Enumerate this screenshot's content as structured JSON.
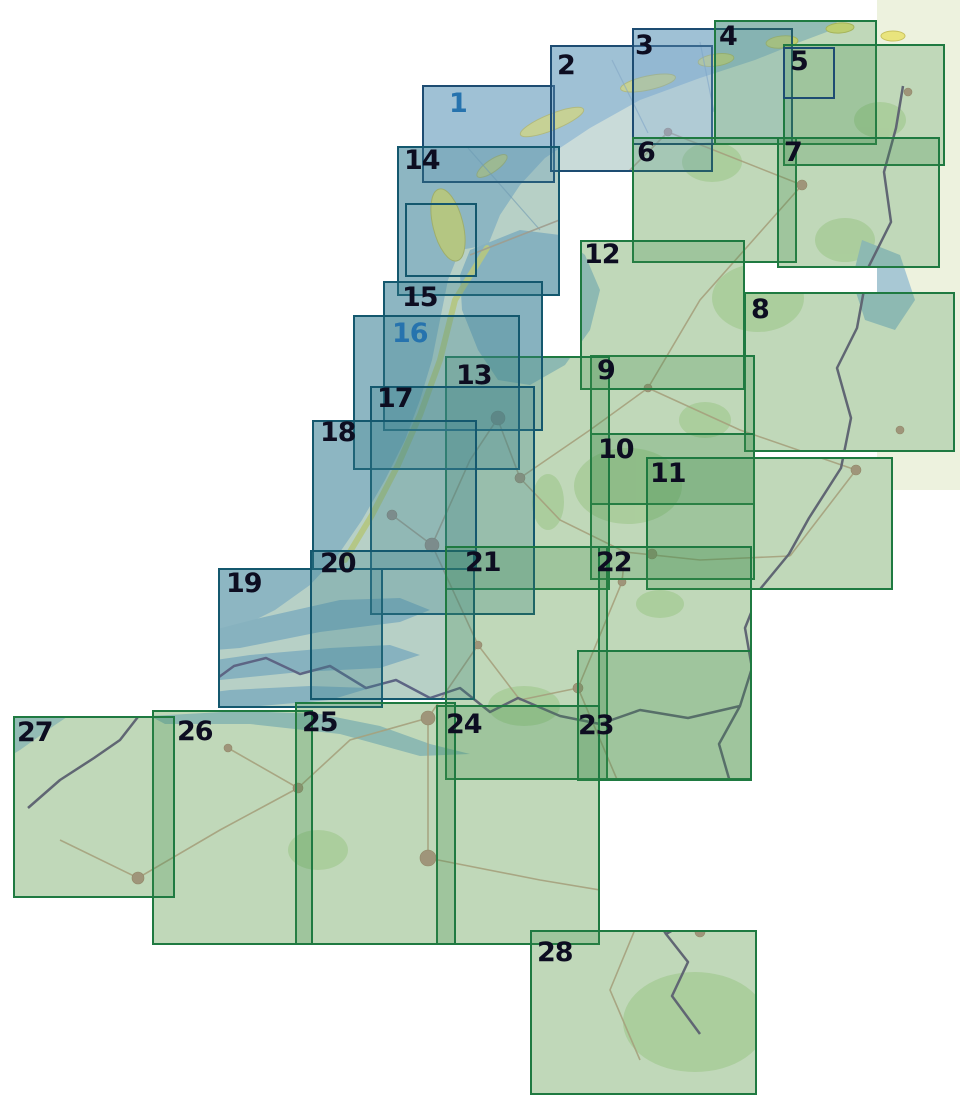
{
  "map_index": {
    "description": "Sheet index map of a 28-part map series covering the Netherlands and Flanders; numbered translucent rectangles overlap a topographic base map",
    "palette": {
      "background": "#ffffff",
      "sea": "#b0cdd9",
      "land": "#edf2de",
      "forest": "#cfe3b6",
      "dune_yellow": "#e9e47d",
      "road": "#c9a88e",
      "city": "#c1998a",
      "country_border": "#6c5a80",
      "admin_sea_line": "#88a6c2",
      "wadden_series_border": "#1d4c72",
      "coast_series_border": "#14586e",
      "inland_series_border": "#1f7a41",
      "wadden_series_fill": "rgba(118,166,204,0.30)",
      "coast_series_fill": "rgba(58,128,142,0.30)",
      "inland_series_fill": "rgba(58,138,74,0.25)",
      "number_color": "#0d0d21",
      "number_highlight_color": "#2673ae"
    },
    "sheets": [
      {
        "number": "1",
        "series": "wadden",
        "x": 422,
        "y": 85,
        "w": 133,
        "h": 98,
        "label_x": 449,
        "label_y": 90,
        "label_color": "blue"
      },
      {
        "number": "2",
        "series": "wadden",
        "x": 550,
        "y": 45,
        "w": 163,
        "h": 127,
        "label_x": 557,
        "label_y": 52,
        "label_color": "dark"
      },
      {
        "number": "3",
        "series": "wadden",
        "x": 632,
        "y": 28,
        "w": 161,
        "h": 117,
        "label_x": 635,
        "label_y": 32,
        "label_color": "dark"
      },
      {
        "number": "4",
        "series": "inland",
        "x": 714,
        "y": 20,
        "w": 163,
        "h": 125,
        "label_x": 719,
        "label_y": 23,
        "label_color": "dark"
      },
      {
        "number": "5",
        "series": "inland",
        "x": 783,
        "y": 44,
        "w": 162,
        "h": 122,
        "label_x": 790,
        "label_y": 48,
        "label_color": "dark"
      },
      {
        "number": "6",
        "series": "inland",
        "x": 632,
        "y": 137,
        "w": 165,
        "h": 126,
        "label_x": 637,
        "label_y": 139,
        "label_color": "dark"
      },
      {
        "number": "7",
        "series": "inland",
        "x": 777,
        "y": 137,
        "w": 163,
        "h": 131,
        "label_x": 784,
        "label_y": 139,
        "label_color": "dark"
      },
      {
        "number": "8",
        "series": "inland",
        "x": 744,
        "y": 292,
        "w": 211,
        "h": 160,
        "label_x": 751,
        "label_y": 296,
        "label_color": "dark"
      },
      {
        "number": "9",
        "series": "inland",
        "x": 590,
        "y": 355,
        "w": 165,
        "h": 150,
        "label_x": 597,
        "label_y": 357,
        "label_color": "dark"
      },
      {
        "number": "10",
        "series": "inland",
        "x": 590,
        "y": 433,
        "w": 165,
        "h": 147,
        "label_x": 598,
        "label_y": 436,
        "label_color": "dark"
      },
      {
        "number": "11",
        "series": "inland",
        "x": 646,
        "y": 457,
        "w": 247,
        "h": 133,
        "label_x": 650,
        "label_y": 460,
        "label_color": "dark"
      },
      {
        "number": "12",
        "series": "inland",
        "x": 580,
        "y": 240,
        "w": 165,
        "h": 150,
        "label_x": 584,
        "label_y": 241,
        "label_color": "dark"
      },
      {
        "number": "13",
        "series": "inland",
        "x": 445,
        "y": 356,
        "w": 165,
        "h": 234,
        "label_x": 456,
        "label_y": 362,
        "label_color": "dark"
      },
      {
        "number": "14",
        "series": "coast",
        "x": 397,
        "y": 146,
        "w": 163,
        "h": 150,
        "label_x": 404,
        "label_y": 147,
        "label_color": "dark"
      },
      {
        "number": "15",
        "series": "coast",
        "x": 383,
        "y": 281,
        "w": 160,
        "h": 150,
        "label_x": 402,
        "label_y": 284,
        "label_color": "dark"
      },
      {
        "number": "16",
        "series": "coast",
        "x": 353,
        "y": 315,
        "w": 167,
        "h": 155,
        "label_x": 392,
        "label_y": 320,
        "label_color": "blue"
      },
      {
        "number": "17",
        "series": "coast",
        "x": 370,
        "y": 386,
        "w": 165,
        "h": 229,
        "label_x": 377,
        "label_y": 385,
        "label_color": "dark"
      },
      {
        "number": "18",
        "series": "coast",
        "x": 312,
        "y": 420,
        "w": 165,
        "h": 150,
        "label_x": 320,
        "label_y": 419,
        "label_color": "dark"
      },
      {
        "number": "19",
        "series": "coast",
        "x": 218,
        "y": 568,
        "w": 165,
        "h": 140,
        "label_x": 226,
        "label_y": 570,
        "label_color": "dark"
      },
      {
        "number": "20",
        "series": "coast",
        "x": 310,
        "y": 550,
        "w": 165,
        "h": 150,
        "label_x": 320,
        "label_y": 550,
        "label_color": "dark"
      },
      {
        "number": "21",
        "series": "inland",
        "x": 445,
        "y": 546,
        "w": 163,
        "h": 234,
        "label_x": 465,
        "label_y": 549,
        "label_color": "dark"
      },
      {
        "number": "22",
        "series": "inland",
        "x": 598,
        "y": 546,
        "w": 154,
        "h": 234,
        "label_x": 596,
        "label_y": 549,
        "label_color": "dark"
      },
      {
        "number": "23",
        "series": "inland",
        "x": 577,
        "y": 650,
        "w": 175,
        "h": 131,
        "label_x": 578,
        "label_y": 712,
        "label_color": "dark"
      },
      {
        "number": "24",
        "series": "inland",
        "x": 436,
        "y": 705,
        "w": 164,
        "h": 240,
        "label_x": 446,
        "label_y": 711,
        "label_color": "dark"
      },
      {
        "number": "25",
        "series": "inland",
        "x": 295,
        "y": 702,
        "w": 161,
        "h": 243,
        "label_x": 302,
        "label_y": 709,
        "label_color": "dark"
      },
      {
        "number": "26",
        "series": "inland",
        "x": 152,
        "y": 710,
        "w": 161,
        "h": 235,
        "label_x": 177,
        "label_y": 718,
        "label_color": "dark"
      },
      {
        "number": "27",
        "series": "inland",
        "x": 13,
        "y": 716,
        "w": 162,
        "h": 182,
        "label_x": 17,
        "label_y": 719,
        "label_color": "dark"
      },
      {
        "number": "28",
        "series": "inland",
        "x": 530,
        "y": 930,
        "w": 227,
        "h": 165,
        "label_x": 537,
        "label_y": 939,
        "label_color": "dark"
      }
    ],
    "insets": [
      {
        "name": "texel-detail-frame",
        "series": "coast",
        "x": 405,
        "y": 203,
        "w": 72,
        "h": 74
      },
      {
        "name": "north-detail-frame",
        "series": "wadden",
        "x": 783,
        "y": 47,
        "w": 52,
        "h": 52
      }
    ]
  }
}
